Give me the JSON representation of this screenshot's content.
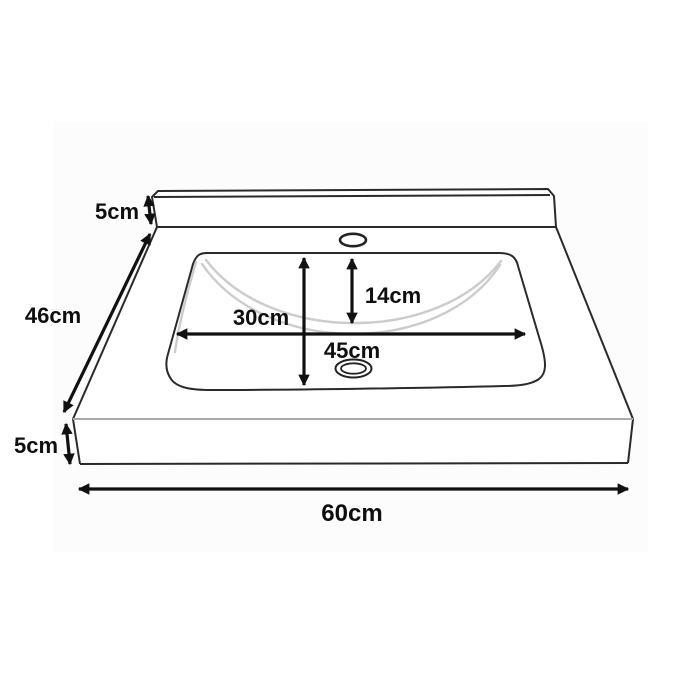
{
  "diagram": {
    "type": "technical-dimension-diagram",
    "subject": "countertop washbasin with backsplash, perspective line drawing",
    "labels": {
      "backsplash_height": "5cm",
      "overall_depth": "46cm",
      "countertop_thickness": "5cm",
      "overall_width": "60cm",
      "basin_front_to_back": "30cm",
      "basin_inner_depth": "14cm",
      "basin_width": "45cm"
    },
    "colors": {
      "outline": "#2a2a2a",
      "front_edge_line": "#ababab",
      "bowl_contour": "#cccccc",
      "dimension_arrow": "#111111",
      "label_text": "#0f0f0f",
      "background": "#ffffff"
    }
  }
}
